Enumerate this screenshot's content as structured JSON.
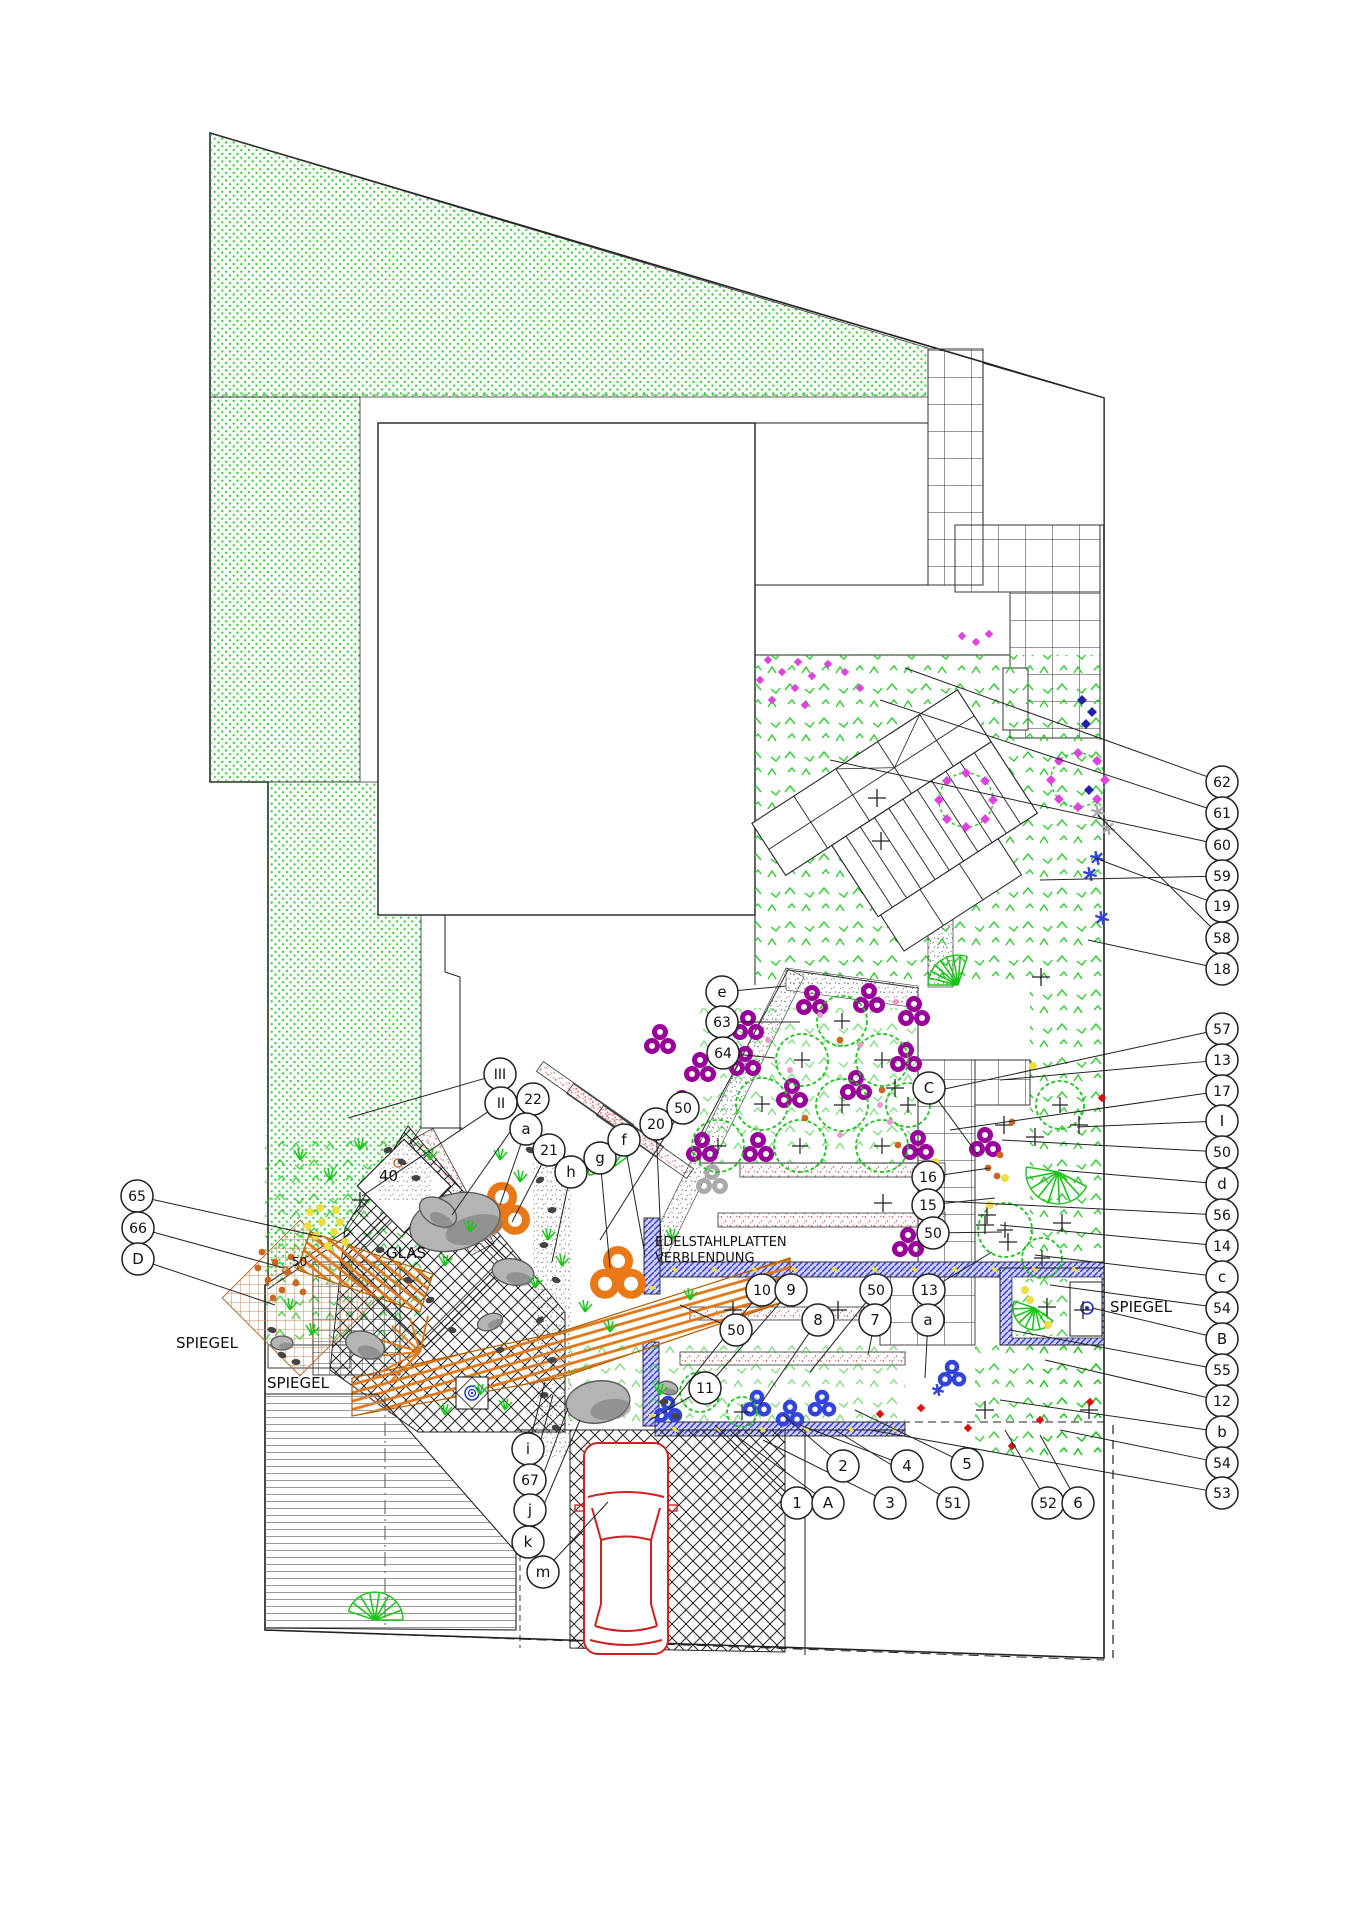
{
  "drawing": {
    "type": "landscape-garden-plan",
    "labels": {
      "spiegel_left_upper": "SPIEGEL",
      "spiegel_left_lower": "SPIEGEL",
      "spiegel_right": "SPIEGEL",
      "glas": "GLAS",
      "area_40": "40",
      "plant_50": "50",
      "cladding_line1": "EDELSTAHLPLATTEN",
      "cladding_line2": "VERBLENDUNG"
    },
    "colors": {
      "lawn_dots": "#33cc33",
      "planting_green": "#1ec41e",
      "purple_flower": "#990099",
      "magenta_flower": "#dd44dd",
      "pink_flower": "#ee99cc",
      "orange_shrub": "#e87818",
      "rust_flower": "#cc6622",
      "yellow_flower": "#eedd44",
      "blue_flower": "#3344dd",
      "red_flower": "#dd1111",
      "gray_flower": "#aaaaaa",
      "water_wall_hatch": "#3a3ad0",
      "boardwalk": "#e07818",
      "tan_lattice": "#cc8855",
      "pink_stipple": "#cc5555",
      "rock_fill": "#b4b4b4",
      "car_outline": "#cc2222",
      "line": "#222222"
    },
    "callouts": [
      {
        "label": "62",
        "x": 1222,
        "y": 782,
        "tx": 905,
        "ty": 668
      },
      {
        "label": "61",
        "x": 1222,
        "y": 813,
        "tx": 880,
        "ty": 700
      },
      {
        "label": "60",
        "x": 1222,
        "y": 845,
        "tx": 830,
        "ty": 760
      },
      {
        "label": "59",
        "x": 1222,
        "y": 876,
        "tx": 1040,
        "ty": 880
      },
      {
        "label": "19",
        "x": 1222,
        "y": 906,
        "tx": 1095,
        "ty": 858
      },
      {
        "label": "58",
        "x": 1222,
        "y": 938,
        "tx": 1098,
        "ty": 815
      },
      {
        "label": "18",
        "x": 1222,
        "y": 969,
        "tx": 1088,
        "ty": 940
      },
      {
        "label": "57",
        "x": 1222,
        "y": 1029,
        "tx": 940,
        "ty": 1090
      },
      {
        "label": "13",
        "x": 1222,
        "y": 1060,
        "tx": 1000,
        "ty": 1080
      },
      {
        "label": "17",
        "x": 1222,
        "y": 1091,
        "tx": 950,
        "ty": 1130
      },
      {
        "label": "I",
        "x": 1222,
        "y": 1121,
        "tx": 1077,
        "ty": 1127
      },
      {
        "label": "50",
        "x": 1222,
        "y": 1152,
        "tx": 1002,
        "ty": 1140
      },
      {
        "label": "d",
        "x": 1222,
        "y": 1184,
        "tx": 1058,
        "ty": 1170
      },
      {
        "label": "56",
        "x": 1222,
        "y": 1215,
        "tx": 920,
        "ty": 1200
      },
      {
        "label": "14",
        "x": 1222,
        "y": 1246,
        "tx": 1000,
        "ty": 1225
      },
      {
        "label": "c",
        "x": 1222,
        "y": 1277,
        "tx": 1035,
        "ty": 1255
      },
      {
        "label": "54",
        "x": 1222,
        "y": 1308,
        "tx": 1050,
        "ty": 1285
      },
      {
        "label": "B",
        "x": 1222,
        "y": 1339,
        "tx": 1092,
        "ty": 1308
      },
      {
        "label": "55",
        "x": 1222,
        "y": 1370,
        "tx": 1010,
        "ty": 1330
      },
      {
        "label": "12",
        "x": 1222,
        "y": 1401,
        "tx": 1045,
        "ty": 1360
      },
      {
        "label": "b",
        "x": 1222,
        "y": 1432,
        "tx": 1000,
        "ty": 1400
      },
      {
        "label": "54",
        "x": 1222,
        "y": 1463,
        "tx": 1060,
        "ty": 1430
      },
      {
        "label": "53",
        "x": 1222,
        "y": 1493,
        "tx": 870,
        "ty": 1430
      },
      {
        "label": "65",
        "x": 137,
        "y": 1196,
        "tx": 322,
        "ty": 1237
      },
      {
        "label": "66",
        "x": 138,
        "y": 1228,
        "tx": 284,
        "ty": 1268
      },
      {
        "label": "D",
        "x": 138,
        "y": 1259,
        "tx": 275,
        "ty": 1305
      },
      {
        "label": "III",
        "x": 500,
        "y": 1074,
        "tx": 348,
        "ty": 1118
      },
      {
        "label": "II",
        "x": 501,
        "y": 1103,
        "tx": 362,
        "ty": 1196
      },
      {
        "label": "22",
        "x": 533,
        "y": 1099,
        "tx": 452,
        "ty": 1215
      },
      {
        "label": "a",
        "x": 526,
        "y": 1129,
        "tx": 500,
        "ty": 1205
      },
      {
        "label": "21",
        "x": 549,
        "y": 1150,
        "tx": 512,
        "ty": 1222
      },
      {
        "label": "h",
        "x": 571,
        "y": 1172,
        "tx": 552,
        "ty": 1262
      },
      {
        "label": "g",
        "x": 600,
        "y": 1158,
        "tx": 610,
        "ty": 1268
      },
      {
        "label": "f",
        "x": 624,
        "y": 1140,
        "tx": 645,
        "ty": 1255
      },
      {
        "label": "20",
        "x": 656,
        "y": 1124,
        "tx": 662,
        "ty": 1265
      },
      {
        "label": "50",
        "x": 683,
        "y": 1108,
        "tx": 600,
        "ty": 1240
      },
      {
        "label": "e",
        "x": 722,
        "y": 992,
        "tx": 786,
        "ty": 986
      },
      {
        "label": "63",
        "x": 722,
        "y": 1022,
        "tx": 800,
        "ty": 1022
      },
      {
        "label": "64",
        "x": 723,
        "y": 1053,
        "tx": 775,
        "ty": 1058
      },
      {
        "label": "C",
        "x": 929,
        "y": 1088,
        "tx": 978,
        "ty": 1155
      },
      {
        "label": "16",
        "x": 928,
        "y": 1177,
        "tx": 990,
        "ty": 1168
      },
      {
        "label": "15",
        "x": 928,
        "y": 1205,
        "tx": 995,
        "ty": 1198
      },
      {
        "label": "50",
        "x": 933,
        "y": 1233,
        "tx": 1002,
        "ty": 1232
      },
      {
        "label": "13",
        "x": 929,
        "y": 1290,
        "tx": 992,
        "ty": 1252
      },
      {
        "label": "10",
        "x": 762,
        "y": 1290,
        "tx": 668,
        "ty": 1408
      },
      {
        "label": "9",
        "x": 791,
        "y": 1290,
        "tx": 700,
        "ty": 1395
      },
      {
        "label": "50",
        "x": 876,
        "y": 1290,
        "tx": 810,
        "ty": 1372
      },
      {
        "label": "8",
        "x": 818,
        "y": 1320,
        "tx": 760,
        "ty": 1405
      },
      {
        "label": "7",
        "x": 875,
        "y": 1320,
        "tx": 868,
        "ty": 1355
      },
      {
        "label": "a",
        "x": 928,
        "y": 1320,
        "tx": 925,
        "ty": 1378
      },
      {
        "label": "50",
        "x": 736,
        "y": 1330,
        "tx": 680,
        "ty": 1305
      },
      {
        "label": "11",
        "x": 705,
        "y": 1388,
        "tx": 650,
        "ty": 1420
      },
      {
        "label": "1",
        "x": 797,
        "y": 1503,
        "tx": 715,
        "ty": 1425
      },
      {
        "label": "A",
        "x": 828,
        "y": 1503,
        "tx": 735,
        "ty": 1435
      },
      {
        "label": "3",
        "x": 890,
        "y": 1503,
        "tx": 763,
        "ty": 1440
      },
      {
        "label": "2",
        "x": 843,
        "y": 1466,
        "tx": 783,
        "ty": 1415
      },
      {
        "label": "4",
        "x": 907,
        "y": 1466,
        "tx": 800,
        "ty": 1425
      },
      {
        "label": "51",
        "x": 953,
        "y": 1503,
        "tx": 835,
        "ty": 1430
      },
      {
        "label": "5",
        "x": 967,
        "y": 1464,
        "tx": 855,
        "ty": 1410
      },
      {
        "label": "52",
        "x": 1048,
        "y": 1503,
        "tx": 1005,
        "ty": 1430
      },
      {
        "label": "6",
        "x": 1078,
        "y": 1503,
        "tx": 1040,
        "ty": 1435
      },
      {
        "label": "i",
        "x": 528,
        "y": 1449,
        "tx": 545,
        "ty": 1382
      },
      {
        "label": "67",
        "x": 530,
        "y": 1480,
        "tx": 553,
        "ty": 1395
      },
      {
        "label": "j",
        "x": 530,
        "y": 1510,
        "tx": 568,
        "ty": 1408
      },
      {
        "label": "k",
        "x": 528,
        "y": 1542,
        "tx": 580,
        "ty": 1420
      },
      {
        "label": "m",
        "x": 543,
        "y": 1572,
        "tx": 608,
        "ty": 1502
      }
    ]
  }
}
